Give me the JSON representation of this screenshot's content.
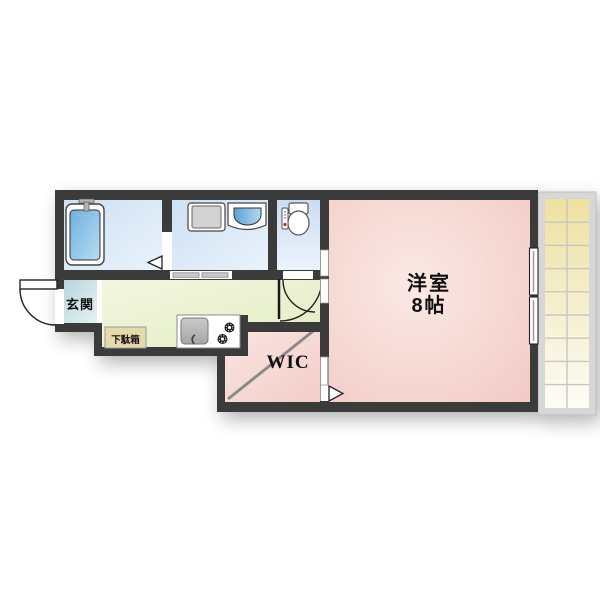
{
  "floorplan": {
    "labels": {
      "western_room": "洋室",
      "western_room_size": "8帖",
      "wic": "WIC",
      "entrance": "玄関",
      "shoe_cabinet": "下駄箱"
    },
    "colors": {
      "wall": "#3b3b3b",
      "bathroom_floor": "#cfe1f4",
      "toilet_floor": "#cbdcf2",
      "entrance_floor": "#b8d6dc",
      "kitchen_floor": "#ecf3d4",
      "western_room_floor": "#f2c9c4",
      "wic_floor": "#f5d4d0",
      "shoe_cabinet_fill": "#e7d9ae",
      "bathtub_fill": "#7db9e2",
      "balcony_tile": "#eee1a0",
      "background": "#ffffff"
    }
  }
}
